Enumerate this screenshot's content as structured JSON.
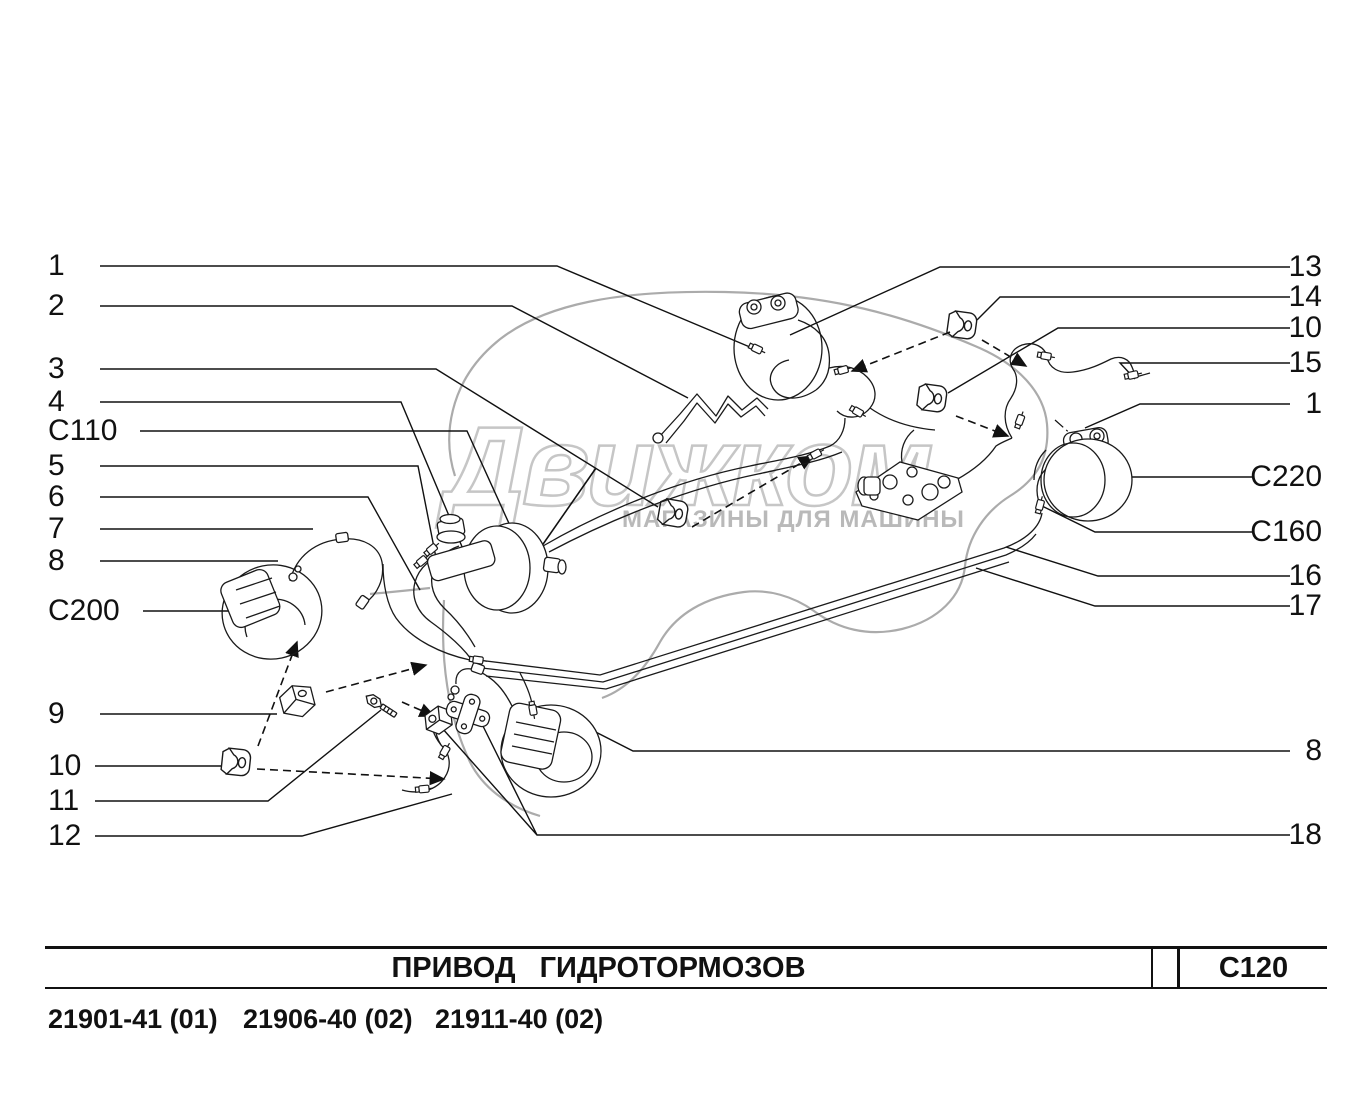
{
  "watermark": {
    "title": "Движком",
    "subtitle": "МАГАЗИНЫ ДЛЯ МАШИНЫ"
  },
  "diagram": {
    "callouts_left": [
      "1",
      "2",
      "3",
      "4",
      "C110",
      "5",
      "6",
      "7",
      "8",
      "C200",
      "9",
      "10",
      "11",
      "12"
    ],
    "callouts_right": [
      "13",
      "14",
      "10",
      "15",
      "1",
      "C220",
      "C160",
      "16",
      "17",
      "8",
      "18"
    ]
  },
  "footer": {
    "title": "ПРИВОД ГИДРОТОРМОЗОВ",
    "code": "C120",
    "models": [
      "21901-41 (01)",
      "21906-40 (02)",
      "21911-40 (02)"
    ]
  },
  "colors": {
    "line": "#1a1a1a",
    "silhouette": "#ababab",
    "watermark_outline": "#c6c6c6",
    "watermark_subtitle": "#b9b9b9"
  }
}
